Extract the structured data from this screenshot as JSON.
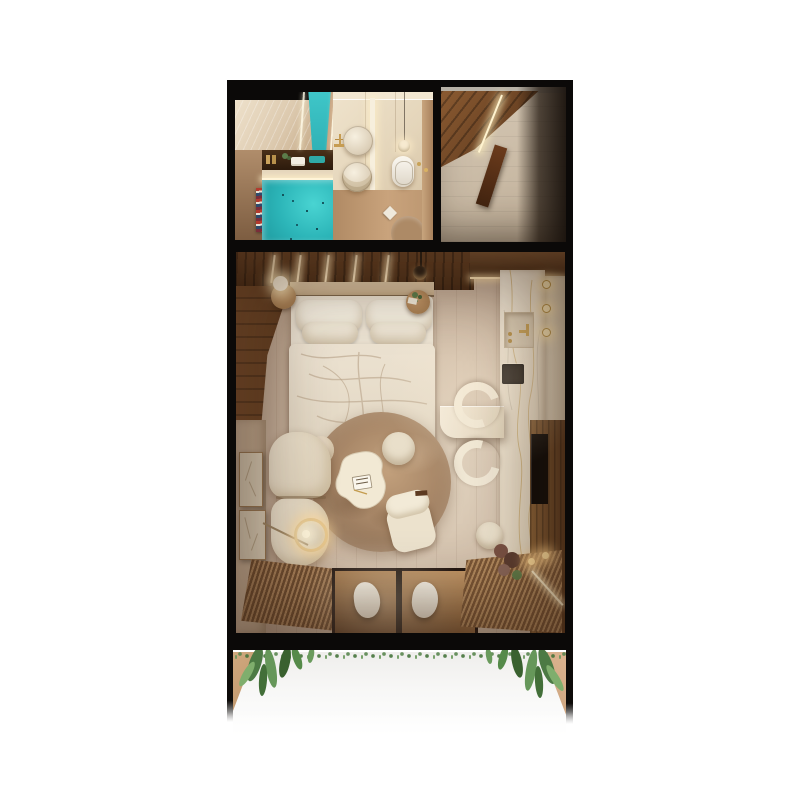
{
  "scene": {
    "kind": "top-down 3d render of a studio apartment floor plan",
    "background_color": "#ffffff",
    "frame_color": "#0b0908",
    "palette": {
      "pool_turquoise": "#3bc5c6",
      "marble_cream": "#ece1cf",
      "wood_dark": "#5d3a22",
      "wood_mid": "#8a5f3e",
      "floor_greige": "#c7b3a0",
      "fabric_cream": "#eae0cc",
      "rug_taupe": "#a8876d",
      "led_warm_glow": "#ffe2ae",
      "plant_green": "#55804d",
      "towel_stripes": [
        "#b33a2e",
        "#e8e2d5",
        "#2e4a6b"
      ]
    },
    "sections": {
      "bathroom": {
        "elements": [
          "travertine-wall",
          "plunge-tub",
          "shower-glass",
          "vanity-shelf",
          "striped-towel-art",
          "double-vessel-sink",
          "gold-faucet",
          "glowing-partition",
          "wall-hung-toilet",
          "pendant-light",
          "round-floor-mat",
          "folded-towel",
          "door-with-gold-handle"
        ]
      },
      "entry_hall": {
        "elements": [
          "wood-ceiling-panel",
          "diagonal-led-strip",
          "leaning-wood-plank",
          "tile-floor",
          "shadowed-corner"
        ]
      },
      "studio": {
        "elements": [
          "slatted-headboard-wall-with-leds",
          "upper-kitchen-cabinet",
          "double-bed-with-pillows-and-duvet",
          "round-nightstand-left-with-sphere-lamp",
          "round-nightstand-right-with-plant",
          "black-pendant-lamp",
          "marble-kitchen-counter",
          "recessed-sink",
          "gold-wall-sconces",
          "black-cooktop",
          "marble-peninsula",
          "two-curved-bar-stools",
          "wood-media-wall",
          "tv-panel",
          "round-taupe-rug",
          "organic-coffee-table-with-book",
          "round-pouf",
          "boucle-lounge-chair",
          "curved-modular-sofa",
          "glowing-ring-floor-lamp",
          "two-abstract-wall-artworks",
          "slatted-deck-left",
          "slatted-deck-right",
          "glass-floor-with-two-hanging-chairs",
          "white-pouf",
          "dried-flower-arrangement",
          "candle-lights",
          "diagonal-led-accent"
        ]
      },
      "balcony": {
        "elements": [
          "hanging-tropical-plants",
          "wood-corner-left",
          "wood-corner-right",
          "bright-white-terrace"
        ]
      }
    }
  }
}
